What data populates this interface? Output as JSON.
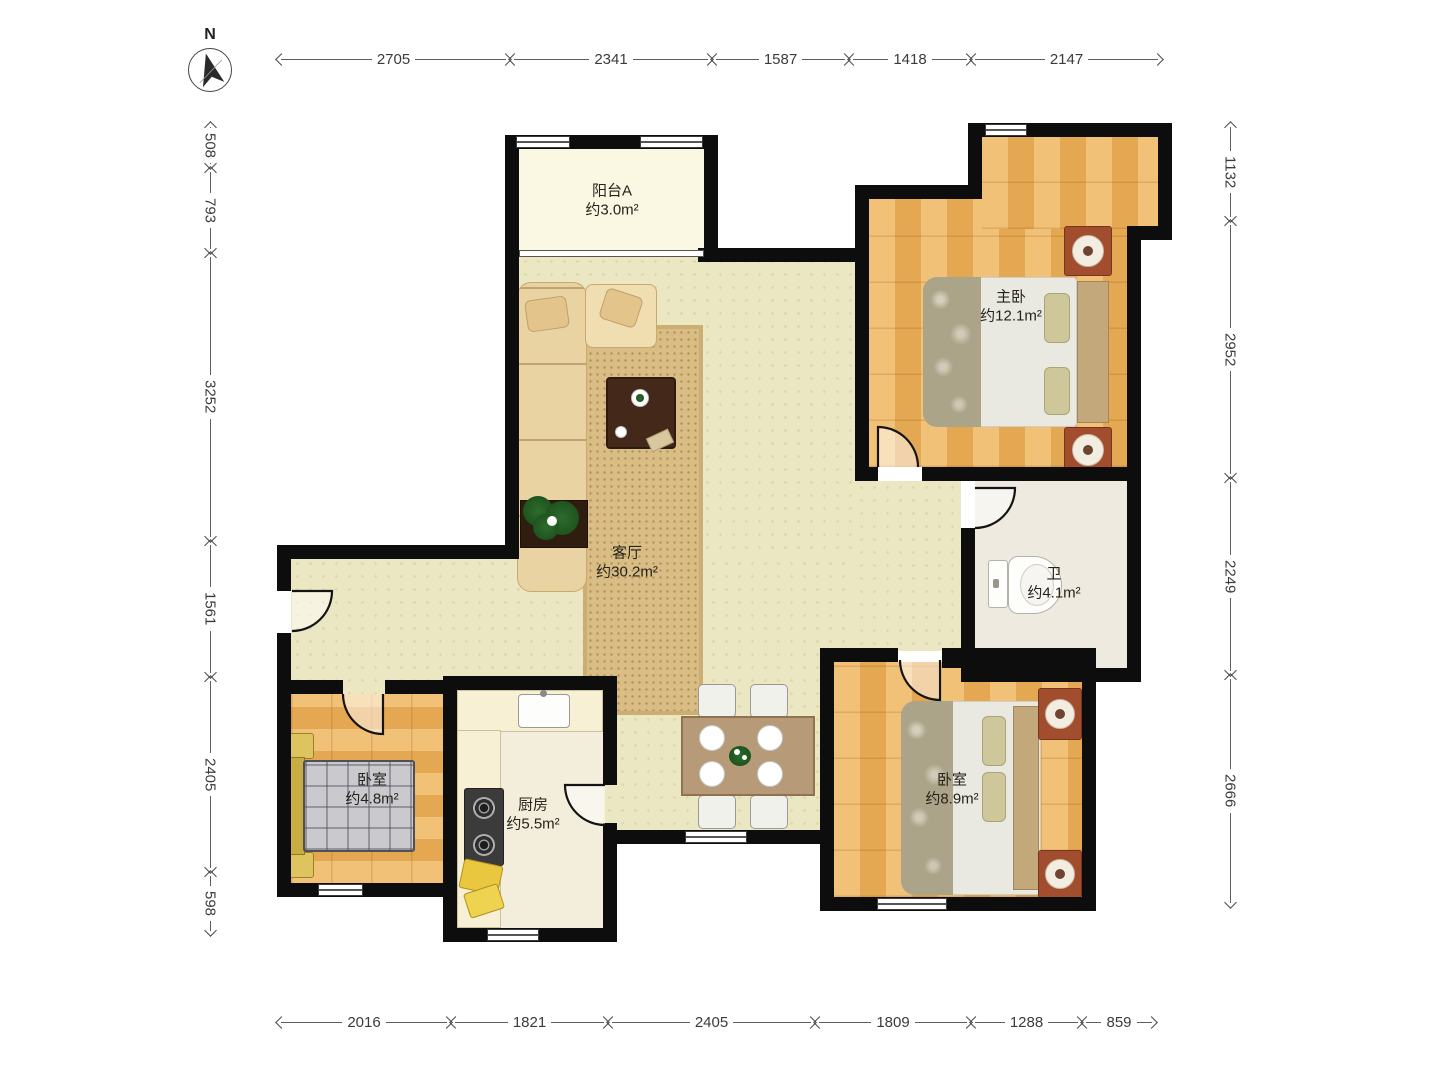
{
  "compass": {
    "label": "N"
  },
  "rooms": {
    "balcony": {
      "name": "阳台A",
      "area": "约3.0m²"
    },
    "master": {
      "name": "主卧",
      "area": "约12.1m²"
    },
    "living": {
      "name": "客厅",
      "area": "约30.2m²"
    },
    "bath": {
      "name": "卫",
      "area": "约4.1m²"
    },
    "bedroom1": {
      "name": "卧室",
      "area": "约4.8m²"
    },
    "kitchen": {
      "name": "厨房",
      "area": "约5.5m²"
    },
    "bedroom2": {
      "name": "卧室",
      "area": "约8.9m²"
    }
  },
  "dimensions": {
    "top": [
      "2705",
      "2341",
      "1587",
      "1418",
      "2147"
    ],
    "bottom": [
      "2016",
      "1821",
      "2405",
      "1809",
      "1288",
      "859"
    ],
    "left": [
      "508",
      "793",
      "3252",
      "1561",
      "2405",
      "598"
    ],
    "right": [
      "1132",
      "2952",
      "2249",
      "2666"
    ]
  },
  "colors": {
    "wall": "#0d0d0d",
    "living_floor": "#ece7c3",
    "wood_floor": "#e9b467",
    "balcony_floor": "#faf7e2",
    "bath_floor": "#efeadf",
    "kitchen_floor": "#f3eedb",
    "dim_line": "#5e5e5e"
  }
}
